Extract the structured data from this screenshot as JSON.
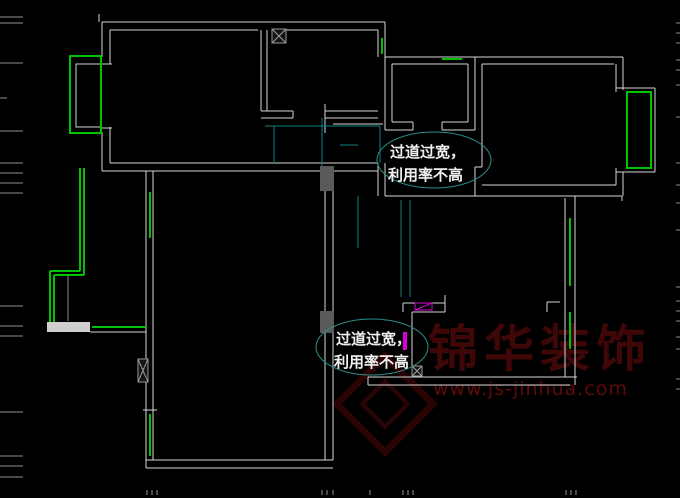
{
  "canvas": {
    "width": 680,
    "height": 498,
    "background": "#000000"
  },
  "colors": {
    "wall": "#d6d6d6",
    "dim_wall": "#8a8a8a",
    "green": "#00c400",
    "cyan": "#0e7f7f",
    "tick": "#8f8f8f",
    "magenta": "#d800d8",
    "column_fill": "#5a5a5a",
    "beam_fill": "#cfcfcf",
    "hatch_stroke": "#9a9a9a",
    "hatch_fill": "#141414",
    "ellipse_stroke": "#2d8f8f",
    "note_text": "#f0f0f0",
    "watermark_title": "#3f0707",
    "watermark_url": "#5e0909",
    "watermark_mark": "#2a0404"
  },
  "annotations": [
    {
      "id": "note-corridor-top",
      "lines": [
        "过道过宽，",
        "利用率不高"
      ],
      "ellipse": {
        "cx": 434,
        "cy": 160,
        "rx": 57,
        "ry": 28
      },
      "text": [
        {
          "x": 390,
          "y": 157
        },
        {
          "x": 388,
          "y": 180
        }
      ],
      "font_size": 15
    },
    {
      "id": "note-corridor-bottom",
      "lines": [
        "过道过宽，",
        "利用率不高"
      ],
      "ellipse": {
        "cx": 372,
        "cy": 347,
        "rx": 56,
        "ry": 28
      },
      "text": [
        {
          "x": 336,
          "y": 344
        },
        {
          "x": 334,
          "y": 367
        }
      ],
      "font_size": 15
    }
  ],
  "watermark": {
    "title": "锦华装饰",
    "url": "www.js-jinhua.com",
    "title_pos": {
      "x": 428,
      "y": 366,
      "font_size": 50,
      "letter_spacing": 6
    },
    "url_pos": {
      "x": 433,
      "y": 395,
      "font_size": 19,
      "letter_spacing": 1
    },
    "marks": [
      {
        "cx": 385,
        "cy": 404,
        "half": 34,
        "stroke_width": 7
      },
      {
        "cx": 385,
        "cy": 404,
        "half": 16,
        "stroke_width": 4
      }
    ]
  },
  "plan": {
    "wall_lines": [
      [
        102,
        22,
        385,
        22
      ],
      [
        110,
        30,
        258,
        30
      ],
      [
        272,
        30,
        378,
        30
      ],
      [
        102,
        22,
        102,
        57
      ],
      [
        102,
        132,
        102,
        171
      ],
      [
        110,
        30,
        110,
        64
      ],
      [
        110,
        127,
        110,
        163
      ],
      [
        101,
        64,
        112,
        64
      ],
      [
        101,
        128,
        112,
        128
      ],
      [
        99,
        14,
        99,
        22
      ],
      [
        261,
        30,
        261,
        111
      ],
      [
        267,
        30,
        267,
        111
      ],
      [
        261,
        111,
        293,
        111
      ],
      [
        261,
        118,
        293,
        118
      ],
      [
        293,
        111,
        293,
        118
      ],
      [
        325,
        111,
        378,
        111
      ],
      [
        325,
        118,
        378,
        118
      ],
      [
        325,
        104,
        325,
        133
      ],
      [
        333,
        124,
        383,
        124
      ],
      [
        378,
        30,
        378,
        57
      ],
      [
        385,
        22,
        385,
        130
      ],
      [
        392,
        64,
        392,
        122
      ],
      [
        385,
        57,
        623,
        57
      ],
      [
        392,
        64,
        468,
        64
      ],
      [
        482,
        64,
        614,
        64
      ],
      [
        468,
        64,
        468,
        122
      ],
      [
        475,
        57,
        475,
        130
      ],
      [
        392,
        122,
        413,
        122
      ],
      [
        385,
        130,
        413,
        130
      ],
      [
        442,
        122,
        468,
        122
      ],
      [
        442,
        130,
        475,
        130
      ],
      [
        413,
        122,
        413,
        130
      ],
      [
        442,
        122,
        442,
        130
      ],
      [
        482,
        64,
        482,
        167
      ],
      [
        475,
        167,
        482,
        167
      ],
      [
        475,
        167,
        475,
        196
      ],
      [
        616,
        64,
        616,
        92
      ],
      [
        623,
        57,
        623,
        90
      ],
      [
        616,
        88,
        655,
        88
      ],
      [
        655,
        88,
        655,
        172
      ],
      [
        616,
        172,
        655,
        172
      ],
      [
        616,
        168,
        616,
        185
      ],
      [
        623,
        172,
        623,
        196
      ],
      [
        482,
        185,
        616,
        185
      ],
      [
        385,
        196,
        622,
        196
      ],
      [
        622,
        196,
        622,
        201
      ],
      [
        378,
        163,
        378,
        196
      ],
      [
        385,
        163,
        385,
        196
      ],
      [
        110,
        163,
        378,
        163
      ],
      [
        102,
        171,
        378,
        171
      ],
      [
        325,
        171,
        325,
        460
      ],
      [
        333,
        171,
        333,
        460
      ],
      [
        146,
        171,
        146,
        468
      ],
      [
        153,
        171,
        153,
        460
      ],
      [
        143,
        410,
        157,
        410
      ],
      [
        146,
        460,
        333,
        460
      ],
      [
        146,
        468,
        333,
        468
      ],
      [
        368,
        377,
        577,
        377
      ],
      [
        368,
        385,
        570,
        385
      ],
      [
        368,
        377,
        368,
        385
      ],
      [
        565,
        198,
        565,
        377
      ],
      [
        575,
        196,
        575,
        385
      ],
      [
        547,
        302,
        560,
        302
      ],
      [
        547,
        302,
        547,
        312
      ],
      [
        403,
        303,
        445,
        303
      ],
      [
        412,
        312,
        445,
        312
      ],
      [
        412,
        312,
        412,
        367
      ],
      [
        403,
        303,
        403,
        312
      ],
      [
        445,
        295,
        445,
        312
      ],
      [
        90,
        332,
        146,
        332
      ],
      [
        50,
        322,
        50,
        332
      ]
    ],
    "dim_wall_lines": [
      [
        68,
        274,
        68,
        321
      ]
    ],
    "window_lines": [
      [
        382,
        38,
        382,
        54
      ],
      [
        442,
        59,
        462,
        59
      ],
      [
        150,
        192,
        150,
        238
      ],
      [
        150,
        414,
        150,
        456
      ],
      [
        570,
        218,
        570,
        286
      ],
      [
        570,
        312,
        570,
        349
      ],
      [
        80,
        168,
        80,
        271
      ],
      [
        50,
        271,
        80,
        271
      ],
      [
        50,
        271,
        50,
        322
      ],
      [
        84,
        168,
        84,
        275
      ],
      [
        54,
        275,
        84,
        275
      ],
      [
        54,
        275,
        54,
        322
      ],
      [
        92,
        327,
        146,
        327
      ]
    ],
    "window_rects": [
      [
        70,
        56,
        31,
        77
      ],
      [
        627,
        92,
        24,
        76
      ]
    ],
    "inner_wall_rects": [
      [
        76,
        64,
        25,
        63
      ]
    ],
    "guide_lines": [
      [
        265,
        126,
        380,
        126
      ],
      [
        274,
        126,
        274,
        163
      ],
      [
        322,
        118,
        322,
        168
      ],
      [
        380,
        126,
        380,
        163
      ],
      [
        358,
        196,
        358,
        248
      ],
      [
        401,
        200,
        401,
        297
      ],
      [
        410,
        200,
        410,
        297
      ],
      [
        340,
        145,
        358,
        145
      ]
    ],
    "fills": [
      [
        320,
        166,
        14,
        25,
        "column_fill"
      ],
      [
        320,
        311,
        14,
        22,
        "column_fill"
      ],
      [
        47,
        322,
        43,
        10,
        "beam_fill"
      ],
      [
        403,
        332,
        4,
        18,
        "magenta"
      ]
    ],
    "hatches": [
      [
        272,
        29,
        14,
        14
      ],
      [
        138,
        359,
        10,
        23
      ],
      [
        412,
        366,
        10,
        10
      ]
    ],
    "magenta_box": {
      "rect": [
        415,
        303,
        17,
        7
      ],
      "diag": [
        415,
        310,
        432,
        303
      ]
    },
    "ticks": {
      "left_y": [
        17,
        23,
        63,
        131,
        163,
        173,
        183,
        193,
        306,
        326,
        336,
        412,
        456,
        466,
        477
      ],
      "left_len": 23,
      "left_short_y": [
        98
      ],
      "left_short_len": 7,
      "right_y": [
        23,
        33,
        43,
        60,
        70,
        85,
        117,
        163,
        185,
        203,
        230,
        287,
        301,
        311,
        321,
        337,
        349,
        379,
        389
      ],
      "right_x0": 676,
      "bottom_x": [
        147,
        152,
        157,
        322,
        327,
        333,
        370,
        403,
        408,
        413,
        566,
        571,
        576
      ],
      "bottom_y0": 490,
      "bottom_len": 5
    }
  }
}
